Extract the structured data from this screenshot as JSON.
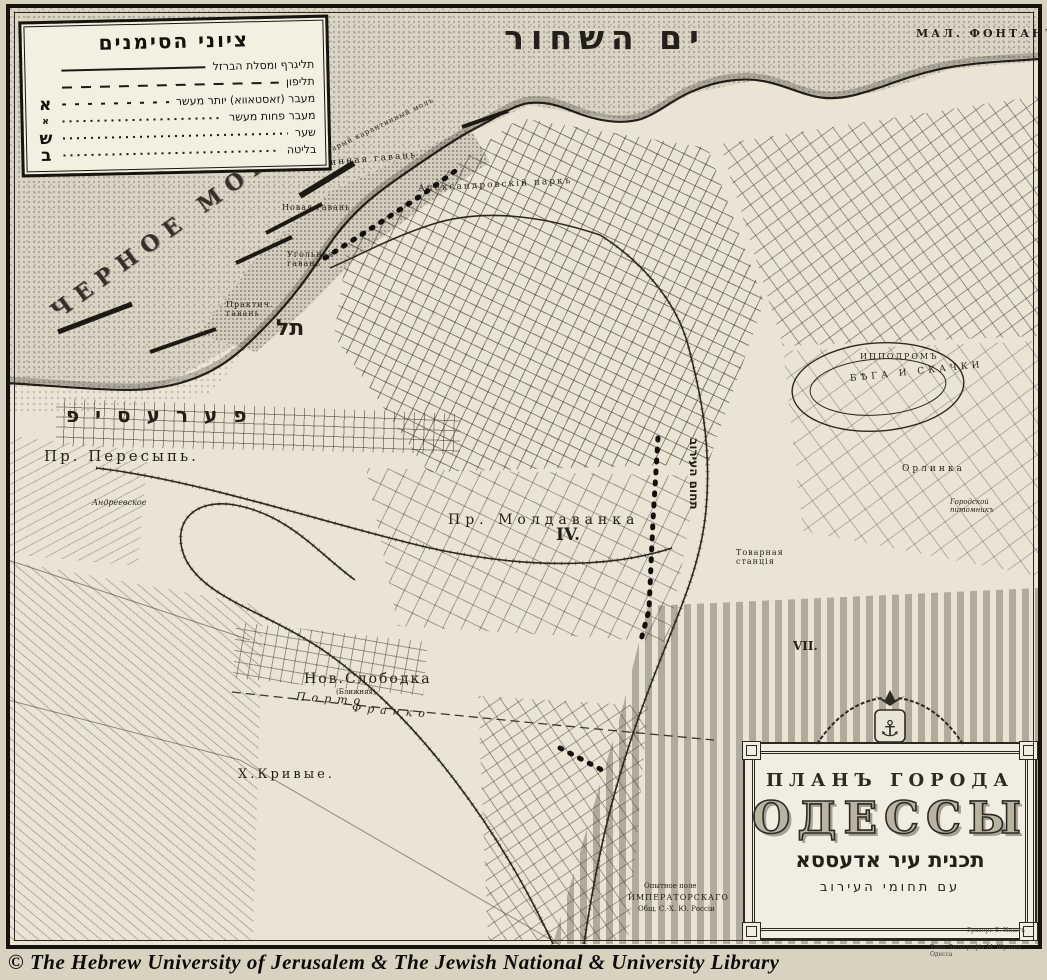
{
  "colors": {
    "paper": "#e9e4d4",
    "ink": "#1d1a14",
    "sea_dot": "#a7a191",
    "frame": "#16130e"
  },
  "sea": {
    "title_he": "ים השחור"
  },
  "legend": {
    "title": "ציוני הסימנים",
    "items": [
      {
        "label": "תליגרף ומסלת הברזל",
        "line": "solid",
        "symbol": "",
        "symbol_size": "big"
      },
      {
        "label": "תליפון",
        "line": "dash",
        "symbol": "",
        "symbol_size": "big"
      },
      {
        "label": "מעבר (זאסטאווא) יותר מעשר",
        "line": "dashdot",
        "symbol": "א",
        "symbol_size": "big"
      },
      {
        "label": "מעבר פחות מעשר",
        "line": "dots",
        "symbol": "א",
        "symbol_size": "small"
      },
      {
        "label": "שער",
        "line": "dots",
        "symbol": "ש",
        "symbol_size": "big"
      },
      {
        "label": "בליטה",
        "line": "dots",
        "symbol": "ב",
        "symbol_size": "big"
      }
    ]
  },
  "map_labels": [
    {
      "name": "label-sea-chernoe-more",
      "text": "ЧЕРНОЕ МОРЕ",
      "x": 54,
      "y": 302,
      "fs": 22,
      "ls": 9,
      "rot": -36,
      "bold": true,
      "cls": "deco"
    },
    {
      "name": "label-mal-fontan",
      "text": "МАЛ. ФОНТАНЪ",
      "x": 916,
      "y": 28,
      "fs": 11,
      "ls": 3,
      "bold": true
    },
    {
      "name": "label-karantinny-mol",
      "text": "Старый карантинный молъ",
      "x": 322,
      "y": 150,
      "fs": 7,
      "ls": 1,
      "rot": -26
    },
    {
      "name": "label-karantinnaya-gavan",
      "text": "Карантинная гавань",
      "x": 284,
      "y": 162,
      "fs": 9,
      "ls": 2,
      "rot": -5
    },
    {
      "name": "label-novaya-gavan",
      "text": "Новая гавань",
      "x": 282,
      "y": 203,
      "fs": 8,
      "ls": 1
    },
    {
      "name": "label-ugolnaya-gavan",
      "text": "Угольная\nгавань",
      "x": 287,
      "y": 250,
      "fs": 8,
      "ls": 1
    },
    {
      "name": "label-prakticheskaya-gavan",
      "text": "Практич.\nгавань",
      "x": 226,
      "y": 300,
      "fs": 8,
      "ls": 1
    },
    {
      "name": "label-alexandrovsky-park",
      "text": "Александровскій паркъ",
      "x": 418,
      "y": 184,
      "fs": 9,
      "ls": 2,
      "rot": -3
    },
    {
      "name": "label-peresyp-hebrew",
      "text": "פערעסיפ",
      "x": 66,
      "y": 404,
      "fs": 20,
      "ls": 16,
      "bold": true,
      "cls": "heb"
    },
    {
      "name": "label-peresyp-russian",
      "text": "Пр. Пересыпь.",
      "x": 44,
      "y": 448,
      "fs": 15,
      "ls": 3
    },
    {
      "name": "label-andreevskoe",
      "text": "Андреевское",
      "x": 92,
      "y": 498,
      "fs": 8,
      "italic": true
    },
    {
      "name": "label-moldavanka",
      "text": "Пр. Молдаванка",
      "x": 448,
      "y": 512,
      "fs": 14,
      "ls": 5
    },
    {
      "name": "label-section-iv",
      "text": "IV.",
      "x": 556,
      "y": 526,
      "fs": 17,
      "bold": true
    },
    {
      "name": "label-ippodrom",
      "text": "ИППОДРОМЪ",
      "x": 860,
      "y": 352,
      "fs": 8,
      "ls": 2
    },
    {
      "name": "label-bega-i-skachki",
      "text": "БѢГА И СКАЧКИ",
      "x": 850,
      "y": 374,
      "fs": 9,
      "ls": 4,
      "rot": -6
    },
    {
      "name": "label-orlinka",
      "text": "Орлинка",
      "x": 902,
      "y": 464,
      "fs": 9,
      "ls": 3
    },
    {
      "name": "label-gorodskoy-pitomnik",
      "text": "Городской\nпитомникъ",
      "x": 950,
      "y": 498,
      "fs": 7,
      "italic": true
    },
    {
      "name": "label-tovarnaya-stantsia",
      "text": "Товарная\nстанція",
      "x": 736,
      "y": 548,
      "fs": 8,
      "ls": 1
    },
    {
      "name": "label-section-vii",
      "text": "VII.",
      "x": 793,
      "y": 640,
      "fs": 12,
      "bold": true
    },
    {
      "name": "label-nov-slobodka",
      "text": "Нов.Слободка",
      "x": 304,
      "y": 671,
      "fs": 14,
      "ls": 2
    },
    {
      "name": "label-slobodka-note",
      "text": "(Ближняя)",
      "x": 336,
      "y": 688,
      "fs": 7
    },
    {
      "name": "label-porto",
      "text": "Порто",
      "x": 296,
      "y": 691,
      "fs": 11,
      "ls": 6,
      "italic": true,
      "rot": 4
    },
    {
      "name": "label-franko",
      "text": "Франко",
      "x": 352,
      "y": 702,
      "fs": 11,
      "ls": 6,
      "italic": true,
      "rot": 5
    },
    {
      "name": "label-kh-krivye",
      "text": "Х.Кривые.",
      "x": 238,
      "y": 768,
      "fs": 13,
      "ls": 3
    },
    {
      "name": "label-opytnoe-pole",
      "text": "Опытное поле",
      "x": 644,
      "y": 882,
      "fs": 7
    },
    {
      "name": "label-imperatorskago",
      "text": "ИМПЕРАТОРСКАГО",
      "x": 628,
      "y": 893,
      "fs": 8,
      "ls": 1
    },
    {
      "name": "label-obshchestvo",
      "text": "Общ. С.-Х. Ю. Россіи",
      "x": 638,
      "y": 905,
      "fs": 7
    },
    {
      "name": "label-eruv-marker-tel",
      "text": "תל",
      "x": 276,
      "y": 316,
      "fs": 22,
      "bold": true,
      "cls": "heb"
    },
    {
      "name": "label-eruv-boundary-vertical",
      "text": "תחום העירוב",
      "x": 686,
      "y": 438,
      "fs": 12,
      "bold": true,
      "cls": "heb vert"
    }
  ],
  "cartouche": {
    "line1": "ПЛАНЪ ГОРОДА",
    "line2": "ОДЕССЫ",
    "line3": "תכנית עיר אדעססא",
    "line4": "עם תחומי העירוב",
    "engraver": "Граверъ Е. Ништъ"
  },
  "imprint": "Типо-Литографія М. Шульце, Одесса",
  "footer": {
    "copyright": "© The Hebrew University of Jerusalem & The Jewish National & University Library"
  }
}
